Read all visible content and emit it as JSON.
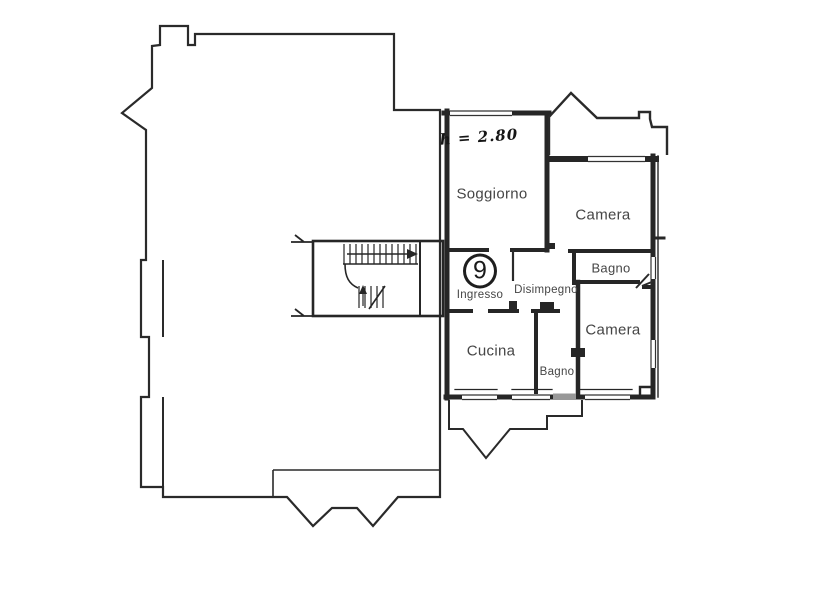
{
  "plan": {
    "unit_number": "9",
    "ceiling_height_note": "h = 2.80",
    "rooms": {
      "soggiorno": "Soggiorno",
      "camera_top": "Camera",
      "bagno_top": "Bagno",
      "disimpegno": "Disimpegno",
      "ingresso": "Ingresso",
      "cucina": "Cucina",
      "bagno_bottom": "Bagno",
      "camera_bottom": "Camera"
    },
    "colors": {
      "wall_line": "#262626",
      "thin_line": "#3a3a3a",
      "label_text": "#454545",
      "background": "#ffffff"
    }
  }
}
